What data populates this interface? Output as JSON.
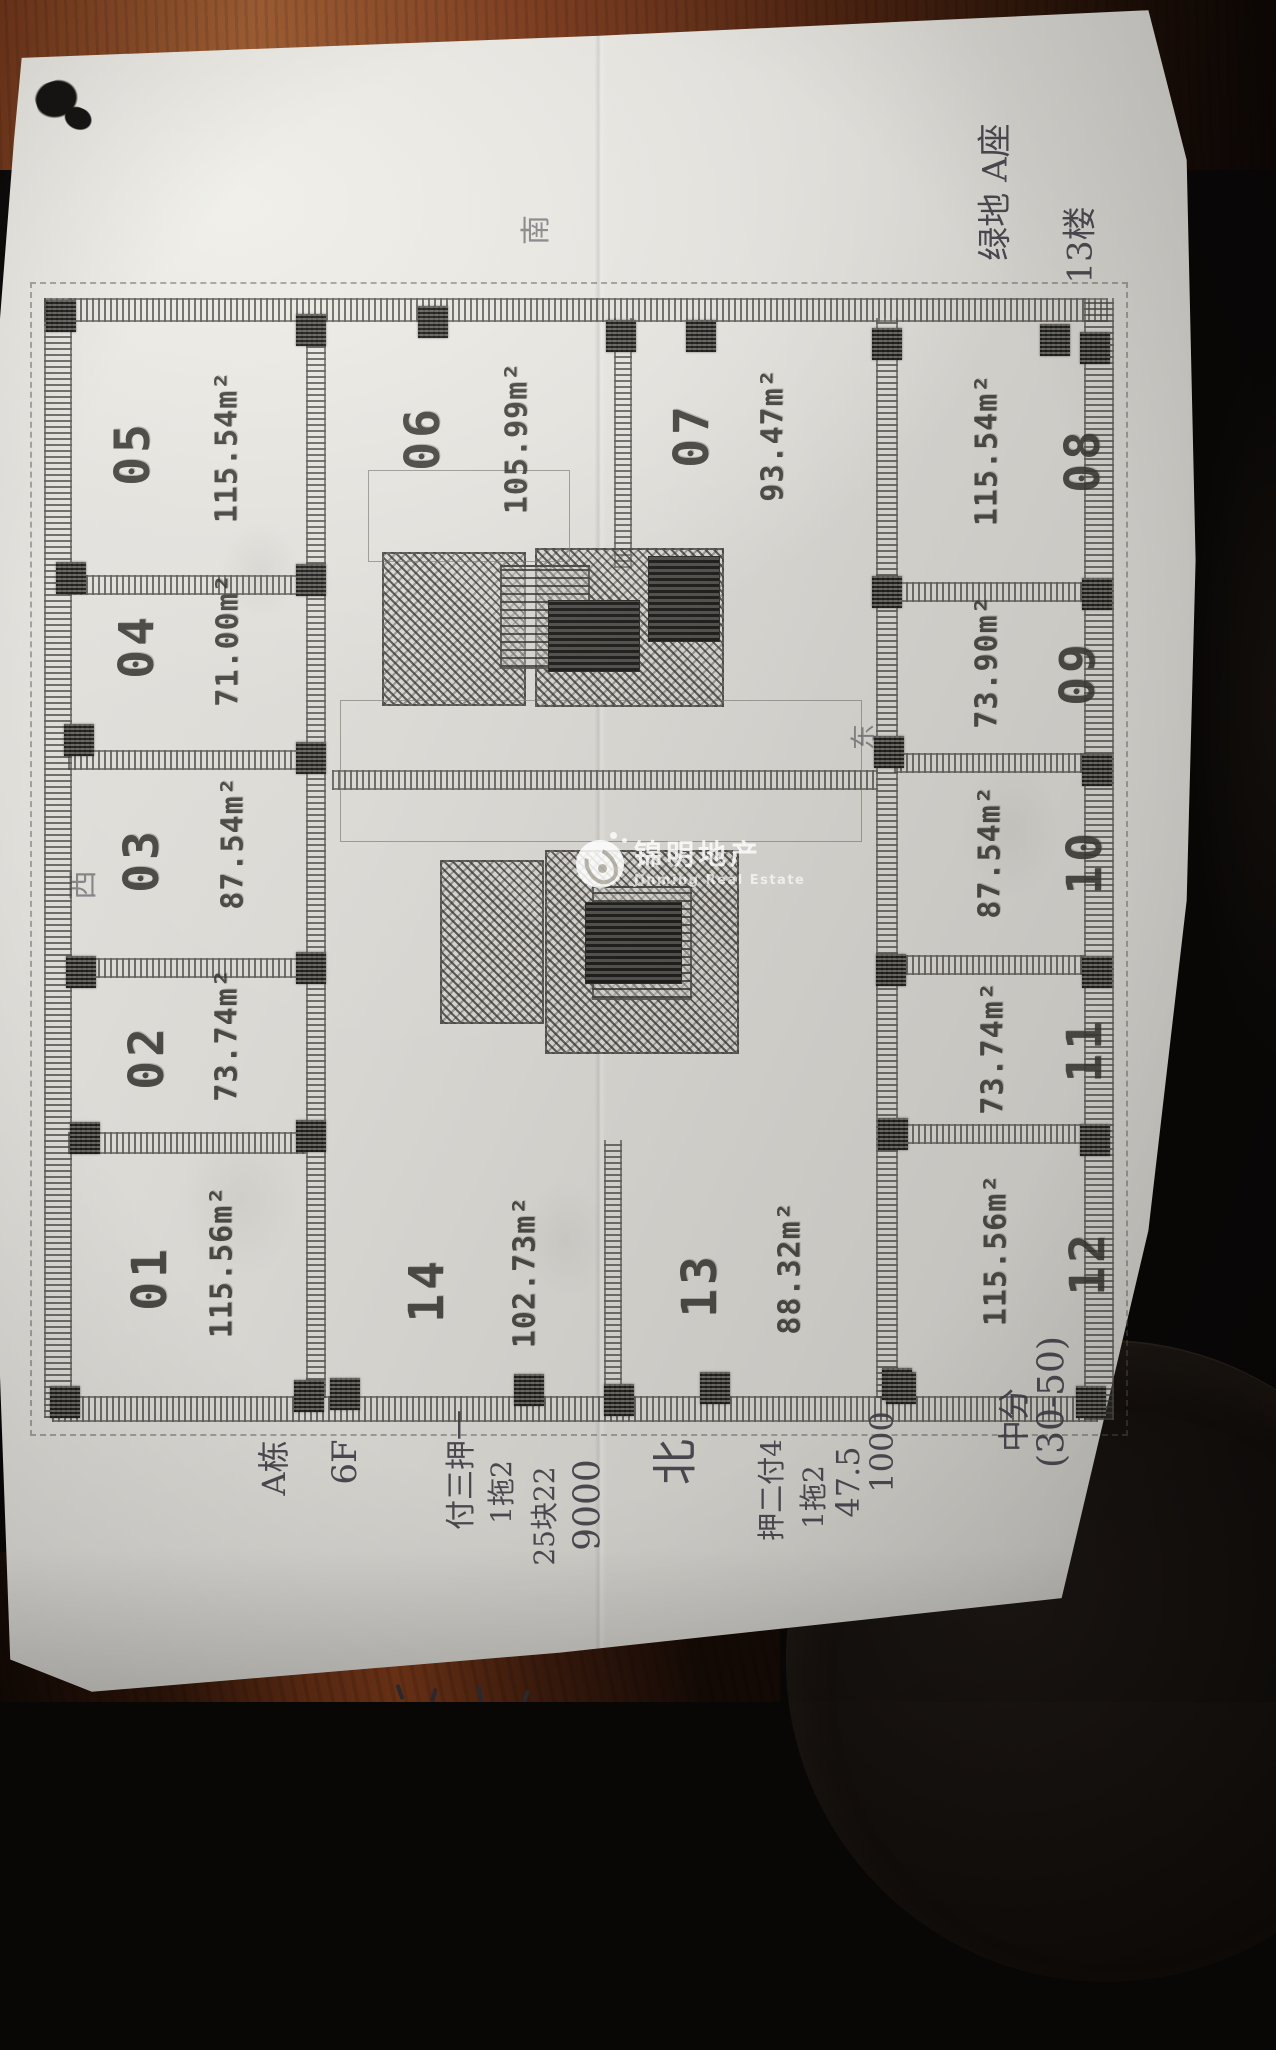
{
  "watermark": {
    "cn": "锦明地产",
    "en": "Jinming Real Estate"
  },
  "floorplan": {
    "area_unit": "m²",
    "units": [
      {
        "id": "01",
        "area": "115.56"
      },
      {
        "id": "02",
        "area": "73.74"
      },
      {
        "id": "03",
        "area": "87.54"
      },
      {
        "id": "04",
        "area": "71.00"
      },
      {
        "id": "05",
        "area": "115.54"
      },
      {
        "id": "06",
        "area": "105.99"
      },
      {
        "id": "07",
        "area": "93.47"
      },
      {
        "id": "08",
        "area": "115.54"
      },
      {
        "id": "09",
        "area": "73.90"
      },
      {
        "id": "10",
        "area": "87.54"
      },
      {
        "id": "11",
        "area": "73.74"
      },
      {
        "id": "12",
        "area": "115.56"
      },
      {
        "id": "13",
        "area": "88.32"
      },
      {
        "id": "14",
        "area": "102.73"
      }
    ]
  },
  "handwriting": {
    "notes": [
      "绿地 A座",
      "13楼",
      "南",
      "西",
      "东",
      "北",
      "A栋",
      "6F",
      "付三押一",
      "1拖2",
      "25块22",
      "9000",
      "押二付4",
      "1拖2",
      "47.5",
      "1000",
      "中分",
      "(30-50)"
    ]
  }
}
